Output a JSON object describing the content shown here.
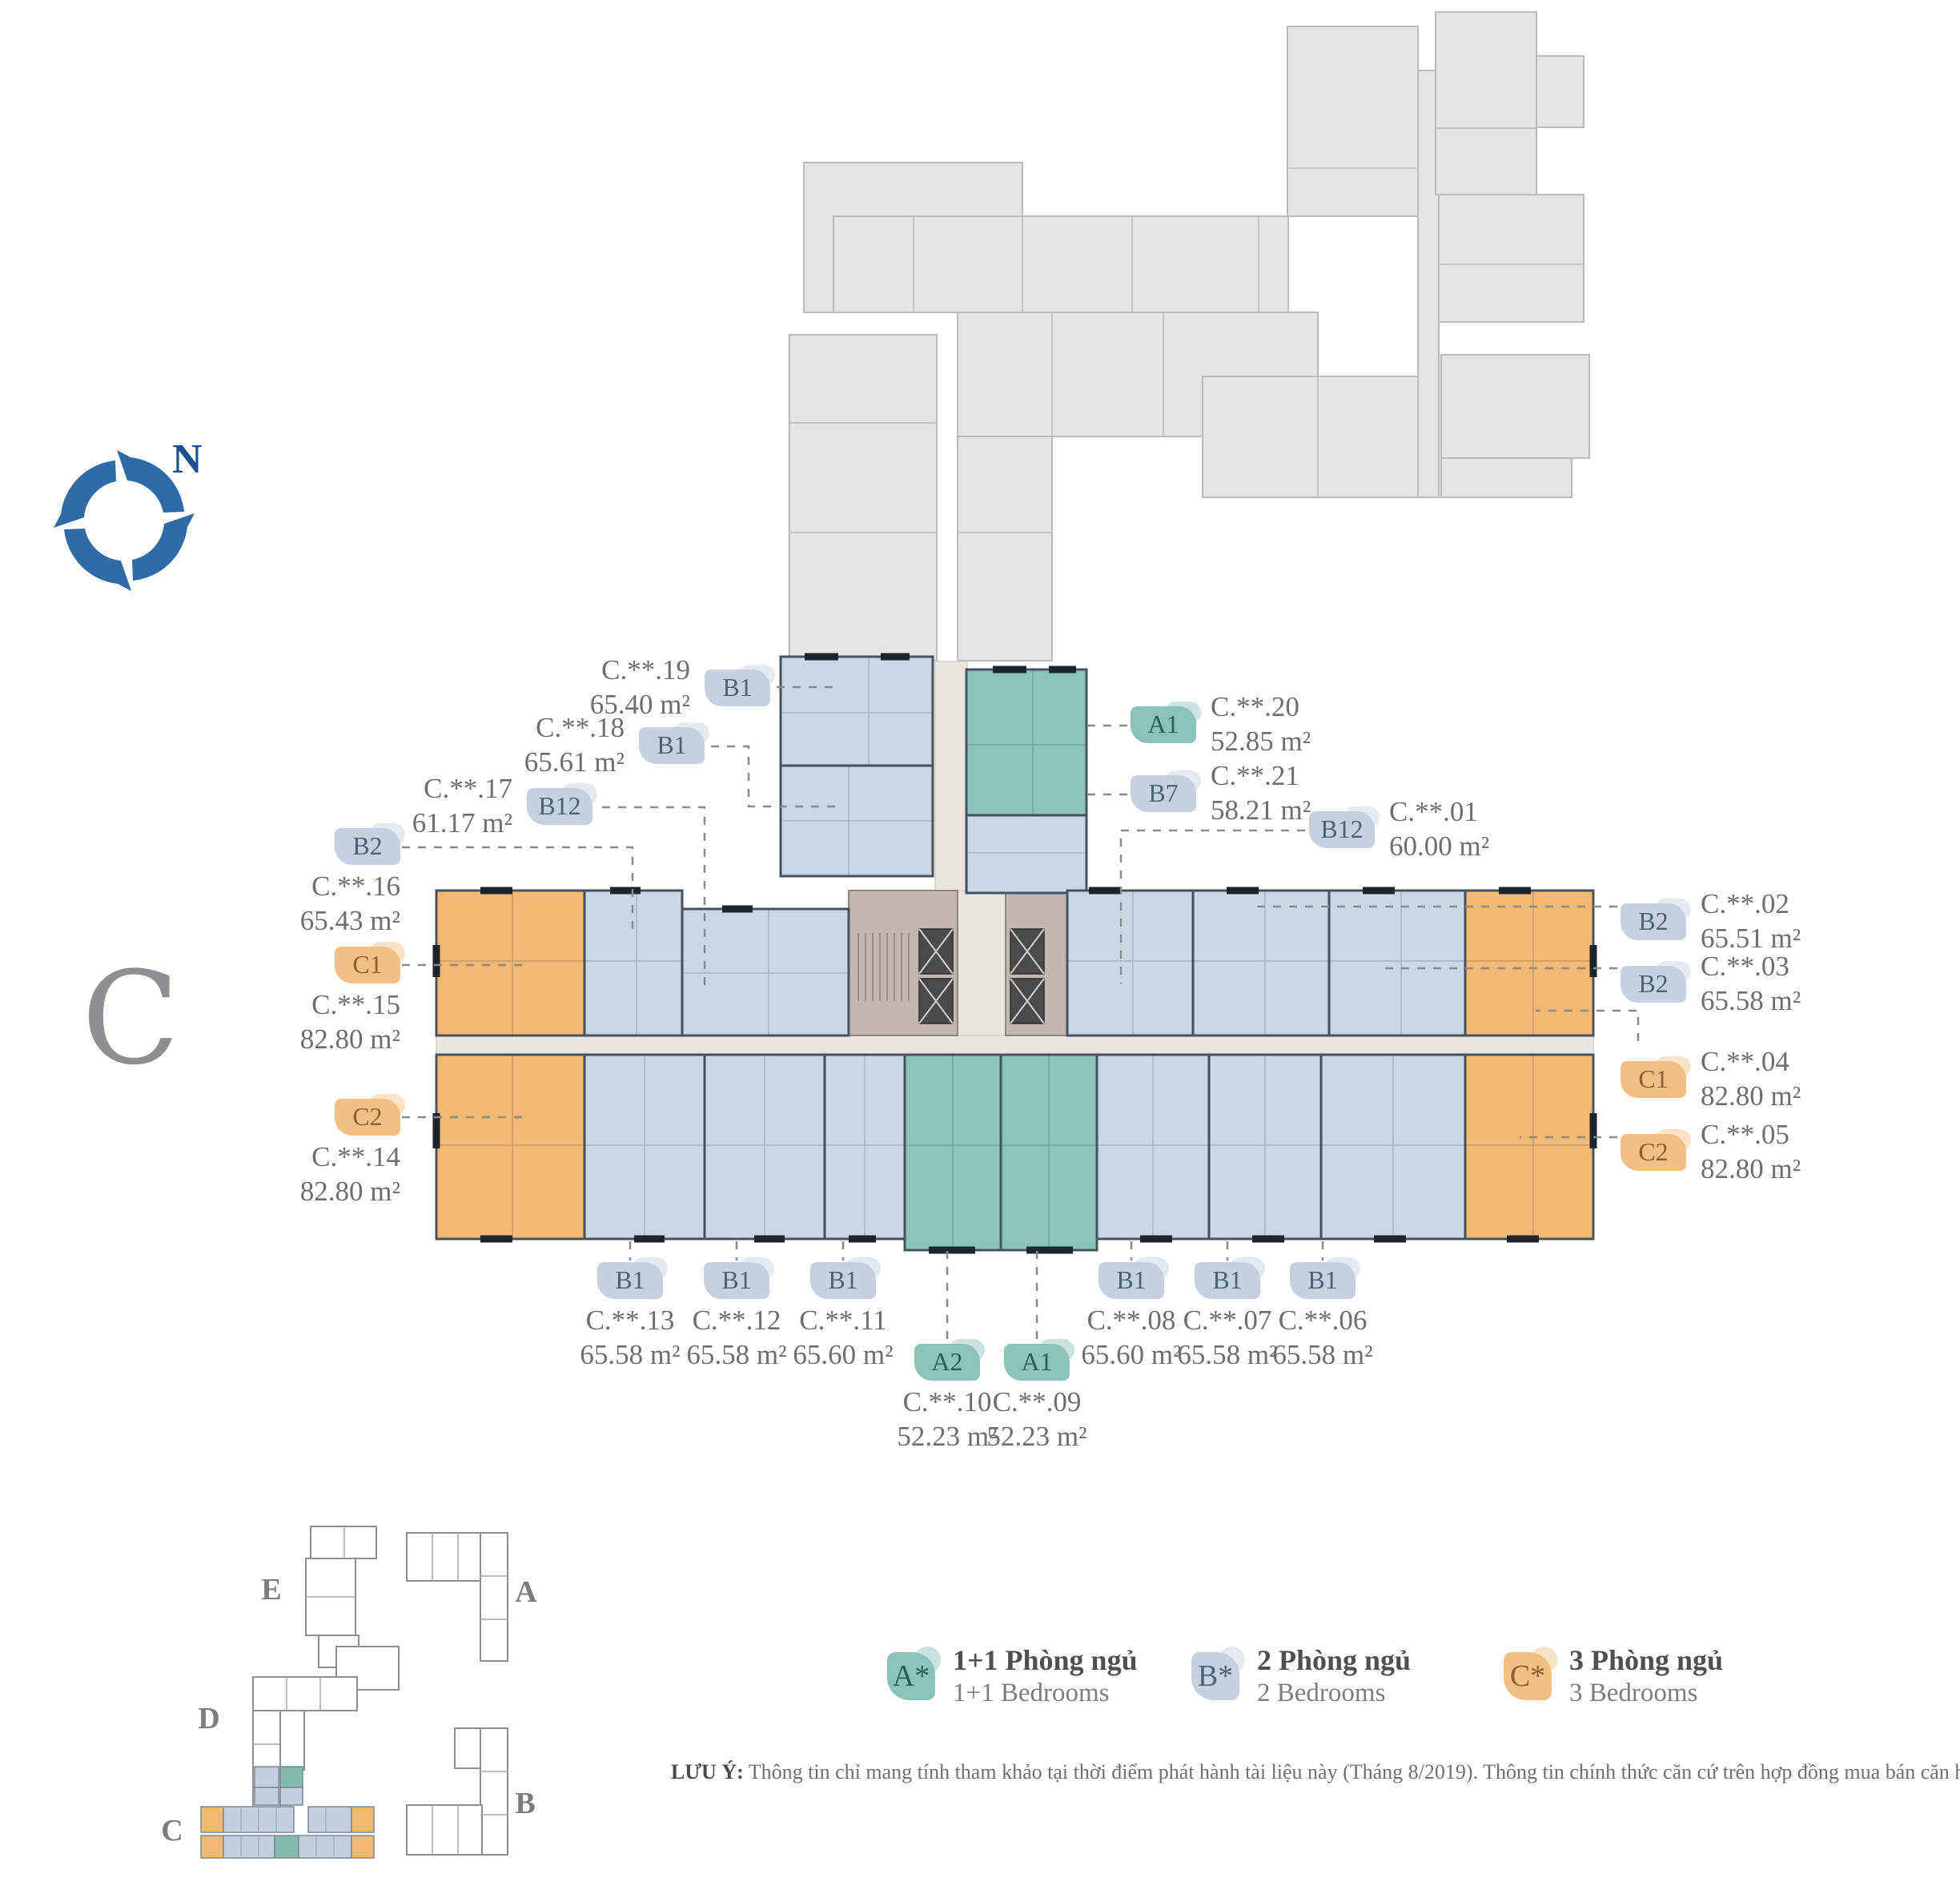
{
  "sheet": {
    "block_letter": "C"
  },
  "compass": {
    "north_label": "N"
  },
  "units": {
    "c19": {
      "code": "C.**.19",
      "type": "B1",
      "area": "65.40 m²"
    },
    "c18": {
      "code": "C.**.18",
      "type": "B1",
      "area": "65.61 m²"
    },
    "c17": {
      "code": "C.**.17",
      "type": "B12",
      "area": "61.17 m²"
    },
    "c16": {
      "code": "C.**.16",
      "type": "B2",
      "area": "65.43 m²"
    },
    "c15": {
      "code": "C.**.15",
      "type": "C1",
      "area": "82.80 m²"
    },
    "c14": {
      "code": "C.**.14",
      "type": "C2",
      "area": "82.80 m²"
    },
    "c20": {
      "code": "C.**.20",
      "type": "A1",
      "area": "52.85 m²"
    },
    "c21": {
      "code": "C.**.21",
      "type": "B7",
      "area": "58.21 m²"
    },
    "c01": {
      "code": "C.**.01",
      "type": "B12",
      "area": "60.00 m²"
    },
    "c02": {
      "code": "C.**.02",
      "type": "B2",
      "area": "65.51 m²"
    },
    "c03": {
      "code": "C.**.03",
      "type": "B2",
      "area": "65.58 m²"
    },
    "c04": {
      "code": "C.**.04",
      "type": "C1",
      "area": "82.80 m²"
    },
    "c05": {
      "code": "C.**.05",
      "type": "C2",
      "area": "82.80 m²"
    },
    "c13": {
      "code": "C.**.13",
      "type": "B1",
      "area": "65.58 m²"
    },
    "c12": {
      "code": "C.**.12",
      "type": "B1",
      "area": "65.58 m²"
    },
    "c11": {
      "code": "C.**.11",
      "type": "B1",
      "area": "65.60 m²"
    },
    "c10": {
      "code": "C.**.10",
      "type": "A2",
      "area": "52.23 m²"
    },
    "c09": {
      "code": "C.**.09",
      "type": "A1",
      "area": "52.23 m²"
    },
    "c08": {
      "code": "C.**.08",
      "type": "B1",
      "area": "65.60 m²"
    },
    "c07": {
      "code": "C.**.07",
      "type": "B1",
      "area": "65.58 m²"
    },
    "c06": {
      "code": "C.**.06",
      "type": "B1",
      "area": "65.58 m²"
    }
  },
  "legend": {
    "a": {
      "code": "A*",
      "vi": "1+1 Phòng ngủ",
      "en": "1+1 Bedrooms"
    },
    "b": {
      "code": "B*",
      "vi": "2 Phòng ngủ",
      "en": "2 Bedrooms"
    },
    "c": {
      "code": "C*",
      "vi": "3 Phòng ngủ",
      "en": "3 Bedrooms"
    }
  },
  "minimap": {
    "blocks": {
      "e": "E",
      "a": "A",
      "d": "D",
      "c": "C",
      "b": "B"
    }
  },
  "note": {
    "label": "LƯU Ý:",
    "text": "Thông tin chỉ mang tính tham khảo tại thời điểm phát hành tài liệu này (Tháng 8/2019). Thông tin chính thức căn cứ trên hợp đồng mua bán căn hộ."
  },
  "colors": {
    "unit_1plus1": "#8cc3b9",
    "unit_2bed": "#ccd7e4",
    "unit_3bed": "#f3b873",
    "badge_a_text": "#2e5f57",
    "badge_b_text": "#4e6274",
    "badge_c_text": "#8a6134",
    "core": "#c2b7b0",
    "corridor": "#eae6df",
    "silhouette": "#e7e4e7",
    "walls": "#47525e",
    "label_text": "#6e6e6e",
    "compass_blue": "#2f6ba6",
    "compass_green": "#58a94b"
  }
}
